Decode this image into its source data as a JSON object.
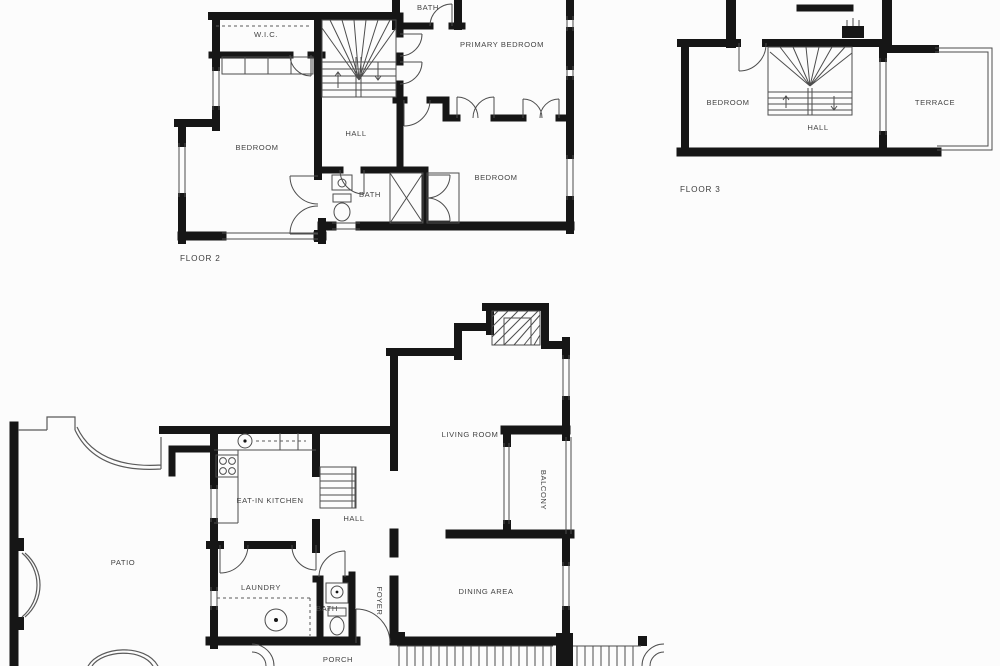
{
  "document": {
    "type": "architectural floor plan",
    "background": "#fcfcfc"
  },
  "colors": {
    "wall": "#161616",
    "thin_line": "#4d4d4d",
    "label_text": "#444444"
  },
  "floor2": {
    "label": "FLOOR 2",
    "rooms": {
      "wic": "W.I.C.",
      "bath_top": "BATH",
      "primary_bedroom": "PRIMARY BEDROOM",
      "hall": "HALL",
      "bedroom_left": "BEDROOM",
      "bath_mid": "BATH",
      "bedroom_right": "BEDROOM"
    }
  },
  "floor3": {
    "label": "FLOOR 3",
    "rooms": {
      "bedroom": "BEDROOM",
      "hall": "HALL",
      "terrace": "TERRACE"
    }
  },
  "floor1": {
    "rooms": {
      "patio": "PATIO",
      "kitchen": "EAT-IN KITCHEN",
      "hall": "HALL",
      "living_room": "LIVING ROOM",
      "balcony": "BALCONY",
      "laundry": "LAUNDRY",
      "bath": "BATH",
      "foyer": "FOYER",
      "dining": "DINING AREA",
      "porch": "PORCH"
    }
  }
}
